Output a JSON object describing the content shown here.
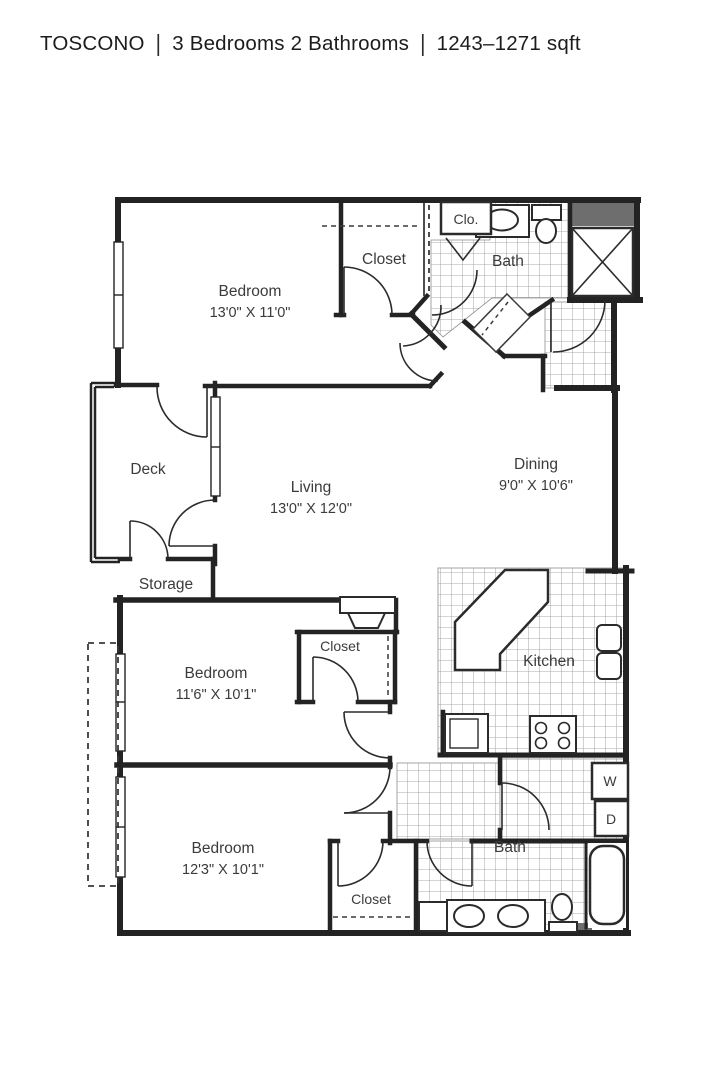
{
  "title": {
    "name": "TOSCONO",
    "separator": "|",
    "specs": "3 Bedrooms 2 Bathrooms",
    "sqft": "1243–1271 sqft"
  },
  "colors": {
    "wall": "#232323",
    "tile_line": "#8f8f8f",
    "dark_fill": "#6e6e6e",
    "label_text": "#3b3b3b"
  },
  "rooms": {
    "bedroom_top": {
      "label": "Bedroom",
      "dims": "13'0\" X 11'0\""
    },
    "closet_top": {
      "label": "Closet"
    },
    "clo": {
      "label": "Clo."
    },
    "bath_top": {
      "label": "Bath"
    },
    "deck": {
      "label": "Deck"
    },
    "living": {
      "label": "Living",
      "dims": "13'0\" X 12'0\""
    },
    "dining": {
      "label": "Dining",
      "dims": "9'0\" X 10'6\""
    },
    "storage": {
      "label": "Storage"
    },
    "kitchen": {
      "label": "Kitchen"
    },
    "bedroom_mid": {
      "label": "Bedroom",
      "dims": "11'6\" X 10'1\""
    },
    "closet_mid": {
      "label": "Closet"
    },
    "bedroom_bottom": {
      "label": "Bedroom",
      "dims": "12'3\" X 10'1\""
    },
    "closet_bottom": {
      "label": "Closet"
    },
    "bath_bottom": {
      "label": "Bath"
    },
    "washer": {
      "label": "W"
    },
    "dryer": {
      "label": "D"
    }
  }
}
